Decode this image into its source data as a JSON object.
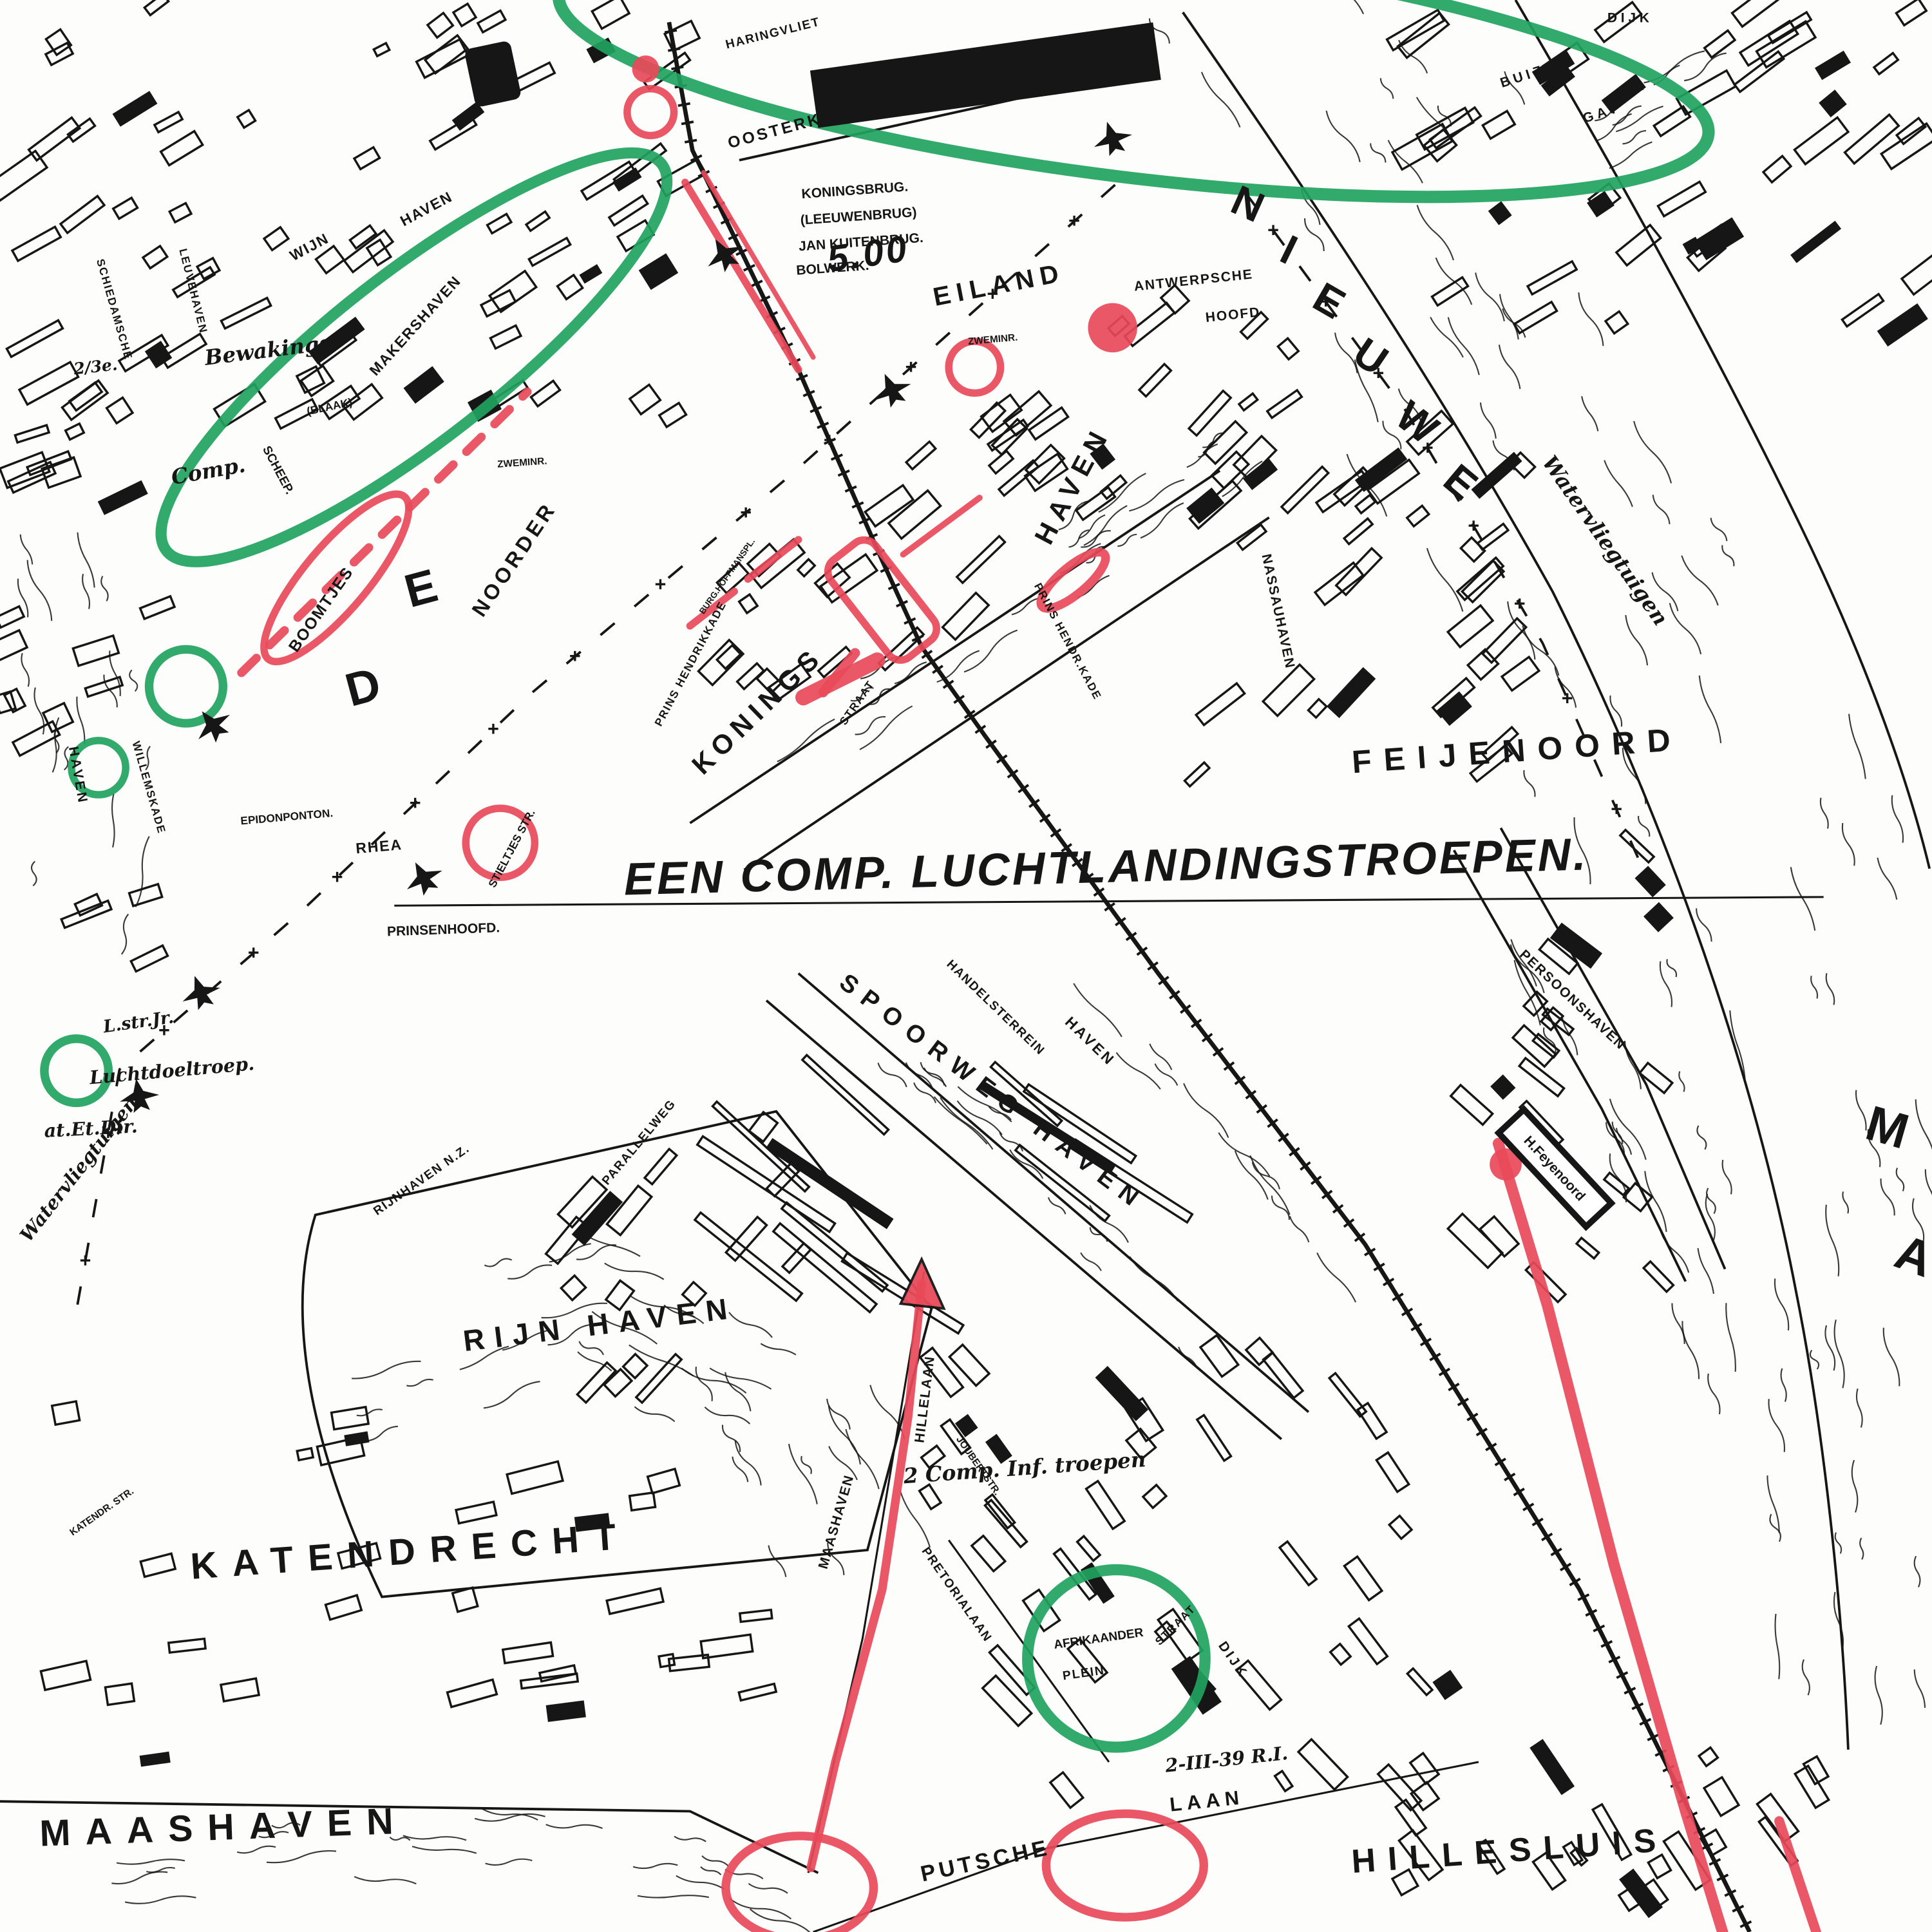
{
  "map": {
    "colors": {
      "red": "#e84a5a",
      "green": "#21a35f",
      "ink": "#161616",
      "paper": "#fdfdfb"
    },
    "signs": {
      "station_maas": "STATION MAAS",
      "beurs_station": "S.S",
      "feijenoord_halt": "H.Feyenoord"
    },
    "labels": [
      [
        "2/3e.",
        78,
        302,
        -6,
        13,
        "s",
        0
      ],
      [
        "Bewakings",
        218,
        290,
        -7,
        17,
        "s",
        0
      ],
      [
        "Comp.",
        170,
        388,
        -10,
        17,
        "s",
        0
      ],
      [
        "(BLAAK)",
        268,
        333,
        -12,
        9,
        "b",
        0
      ],
      [
        "HARINGVLIET",
        628,
        30,
        -14,
        10,
        "b",
        1
      ],
      [
        "OOSTERKADE",
        646,
        106,
        -15,
        13,
        "b",
        2
      ],
      [
        "KONINGSBRUG.",
        694,
        158,
        -4,
        11,
        "b",
        0
      ],
      [
        "(LEEUWENBRUG)",
        697,
        179,
        -4,
        11,
        "b",
        0
      ],
      [
        "JAN KUITENBRUG.",
        699,
        200,
        -4,
        11,
        "b",
        0
      ],
      [
        "BOLWERK.",
        676,
        221,
        -4,
        11,
        "b",
        0
      ],
      [
        "5.00",
        706,
        216,
        -8,
        30,
        "sb",
        0
      ],
      [
        "EILAND",
        812,
        238,
        -11,
        21,
        "b",
        5
      ],
      [
        "ANTWERPSCHE",
        969,
        231,
        -6,
        11,
        "b",
        1
      ],
      [
        "HOOFD",
        1001,
        259,
        -6,
        11,
        "b",
        1
      ],
      [
        "ZWEMINR.",
        806,
        278,
        -5,
        8,
        "b",
        0
      ],
      [
        "ZWEMINR.",
        424,
        378,
        -4,
        8,
        "b",
        0
      ],
      [
        "N",
        1008,
        176,
        24,
        34,
        "b",
        0
      ],
      [
        "I",
        1041,
        213,
        26,
        34,
        "b",
        0
      ],
      [
        "E",
        1073,
        254,
        30,
        34,
        "b",
        0
      ],
      [
        "U",
        1106,
        299,
        34,
        34,
        "b",
        0
      ],
      [
        "W",
        1143,
        352,
        38,
        34,
        "b",
        0
      ],
      [
        "E",
        1178,
        400,
        40,
        34,
        "b",
        0
      ],
      [
        "M",
        1528,
        928,
        16,
        40,
        "b",
        0
      ],
      [
        "A",
        1549,
        1032,
        20,
        40,
        "b",
        0
      ],
      [
        "Watervliegtuigen",
        1298,
        442,
        55,
        17,
        "s",
        0
      ],
      [
        "DIJK",
        1323,
        18,
        0,
        11,
        "b",
        3
      ],
      [
        "BUIZEN",
        1247,
        62,
        -18,
        11,
        "b",
        3
      ],
      [
        "GAT",
        1301,
        95,
        -18,
        11,
        "b",
        3
      ],
      [
        "WIJN",
        253,
        204,
        -28,
        12,
        "b",
        1
      ],
      [
        "HAVEN",
        348,
        173,
        -28,
        12,
        "b",
        1
      ],
      [
        "SCHEEP.",
        223,
        383,
        62,
        10,
        "b",
        0
      ],
      [
        "MAKERSHAVEN",
        340,
        267,
        -48,
        12,
        "b",
        1
      ],
      [
        "BOOMTJES",
        264,
        497,
        -55,
        13,
        "b",
        1
      ],
      [
        "D",
        298,
        570,
        -15,
        38,
        "b",
        0
      ],
      [
        "E",
        345,
        490,
        -15,
        38,
        "b",
        0
      ],
      [
        "NOORDER",
        422,
        457,
        -56,
        17,
        "b",
        3
      ],
      [
        "PRINS HENDRIKKADE",
        563,
        540,
        -62,
        9,
        "b",
        1
      ],
      [
        "BURG.HOFFMANSPL.",
        592,
        469,
        -55,
        7,
        "b",
        0
      ],
      [
        "KONINGS",
        620,
        582,
        -44,
        22,
        "b",
        5
      ],
      [
        "HAVEN",
        877,
        397,
        -62,
        22,
        "b",
        6
      ],
      [
        "PRINS HENDR.KADE",
        864,
        522,
        62,
        9,
        "b",
        1
      ],
      [
        "STRAAT",
        698,
        572,
        -55,
        9,
        "b",
        1
      ],
      [
        "STIELTJES STR.",
        418,
        690,
        -62,
        9,
        "b",
        0
      ],
      [
        "FEIJENOORD",
        1232,
        618,
        -4,
        26,
        "b",
        10
      ],
      [
        "NASSAUHAVEN",
        1034,
        497,
        78,
        11,
        "b",
        1
      ],
      [
        "EEN COMP. LUCHTLANDINGSTROEPEN.",
        898,
        716,
        -1.5,
        37,
        "sb",
        0
      ],
      [
        "PRINSENHOOFD.",
        360,
        758,
        -2,
        11,
        "b",
        0
      ],
      [
        "RHEA",
        308,
        691,
        -5,
        12,
        "b",
        1
      ],
      [
        "EPIDONPONTON.",
        233,
        666,
        -5,
        9,
        "b",
        0
      ],
      [
        "L.str.Jr.",
        113,
        834,
        -8,
        14,
        "s",
        0
      ],
      [
        "Luchtdoeltroep.",
        140,
        874,
        -5,
        15,
        "s",
        0
      ],
      [
        "at.Et.Dir.",
        74,
        921,
        -3,
        15,
        "s",
        0
      ],
      [
        "Watervliegtuigen",
        68,
        952,
        -52,
        15,
        "s",
        0
      ],
      [
        "SPOORWEG HAVEN",
        802,
        892,
        37,
        20,
        "b",
        8
      ],
      [
        "HANDELSTERREIN",
        806,
        820,
        44,
        10,
        "b",
        1
      ],
      [
        "HAVEN",
        882,
        848,
        44,
        12,
        "b",
        2
      ],
      [
        "PERSOONSHAVEN",
        1274,
        814,
        43,
        11,
        "b",
        1
      ],
      [
        "RIJNHAVEN N.Z.",
        344,
        960,
        -35,
        10,
        "b",
        1
      ],
      [
        "PARALLELWEG",
        521,
        929,
        -50,
        10,
        "b",
        1
      ],
      [
        "RIJN HAVEN",
        488,
        1083,
        -7,
        24,
        "b",
        8
      ],
      [
        "KATENDR. STR.",
        84,
        1229,
        -35,
        8,
        "b",
        0
      ],
      [
        "KATENDRECHT",
        334,
        1269,
        -4,
        30,
        "b",
        12
      ],
      [
        "MAASHAVEN",
        682,
        1236,
        -74,
        11,
        "b",
        1
      ],
      [
        "HILLELAAN",
        754,
        1136,
        -83,
        11,
        "b",
        1
      ],
      [
        "2 Comp. Inf. troepen",
        832,
        1197,
        -4,
        17,
        "s",
        0
      ],
      [
        "AFRIKAANDER",
        892,
        1333,
        -8,
        10,
        "b",
        0
      ],
      [
        "PLEIN",
        880,
        1361,
        -8,
        10,
        "b",
        1
      ],
      [
        "PRETORIALAAN",
        774,
        1296,
        55,
        10,
        "b",
        1
      ],
      [
        "JOUBERTSTR.",
        792,
        1191,
        55,
        8,
        "b",
        0
      ],
      [
        "STRAAT",
        956,
        1321,
        -45,
        9,
        "b",
        1
      ],
      [
        "DIJK",
        998,
        1349,
        55,
        11,
        "b",
        2
      ],
      [
        "2-III-39 R.I.",
        996,
        1433,
        -6,
        15,
        "s",
        0
      ],
      [
        "LAAN",
        980,
        1467,
        -6,
        16,
        "b",
        4
      ],
      [
        "PUTSCHE",
        801,
        1516,
        -12,
        18,
        "b",
        3
      ],
      [
        "HILLESLUIS",
        1226,
        1511,
        -4,
        27,
        "b",
        10
      ],
      [
        "MAASHAVEN",
        182,
        1493,
        -2,
        30,
        "b",
        12
      ],
      [
        "WILLEMSKADE",
        118,
        640,
        74,
        9,
        "b",
        1
      ],
      [
        "LEUVEHAVEN",
        154,
        237,
        76,
        9,
        "b",
        1
      ],
      [
        "SCHIEDAMSCHE",
        90,
        252,
        74,
        9,
        "b",
        1
      ],
      [
        "HAVEN",
        60,
        630,
        80,
        11,
        "b",
        2
      ]
    ],
    "planes": [
      [
        163,
        806,
        -20
      ],
      [
        113,
        890,
        -10
      ],
      [
        344,
        713,
        -28
      ],
      [
        724,
        317,
        -24
      ],
      [
        903,
        113,
        -18
      ],
      [
        588,
        207,
        -30
      ],
      [
        173,
        589,
        -38
      ]
    ]
  }
}
